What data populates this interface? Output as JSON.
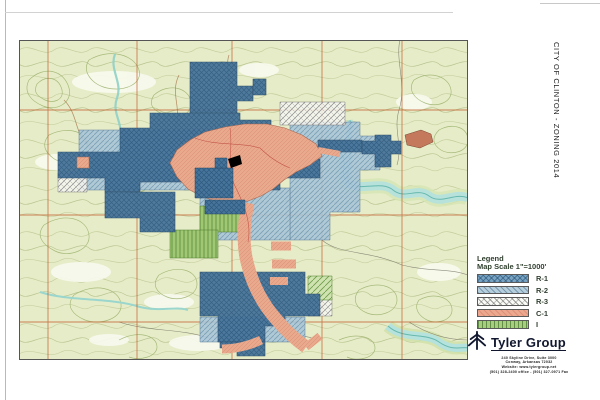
{
  "title": "CITY OF CLINTON - ZONING 2014",
  "legend": {
    "title": "Legend",
    "scale": "Map Scale 1\"=1000'",
    "items": [
      {
        "label": "R-1",
        "color": "#79a3c1",
        "pattern": "blue-crosshatch"
      },
      {
        "label": "R-2",
        "color": "#b7cfdd",
        "pattern": "light-blue-diagonal"
      },
      {
        "label": "R-3",
        "color": "#fbfbf8",
        "pattern": "white-gray-crosshatch"
      },
      {
        "label": "C-1",
        "color": "#eba88e",
        "pattern": "salmon-crosshatch"
      },
      {
        "label": "I",
        "color": "#a8cd7e",
        "pattern": "green-vertical-lines"
      }
    ]
  },
  "company": {
    "name": "Tyler Group",
    "logo_color": "#11172e",
    "address_lines": [
      "240 Skyline Drive, Suite 3000",
      "Conway, Arkansas  72032",
      "Website: www.tylergroup.net",
      "(501) 328-2400 office  -  (501) 327-0971 Fax"
    ]
  },
  "map": {
    "type": "scanned zoning map over USGS topographic base",
    "grid_color": "#c05a28",
    "topo_background": "#e7ecc8",
    "river_color": "#b5e2dc",
    "marker": "black location marker near downtown"
  }
}
